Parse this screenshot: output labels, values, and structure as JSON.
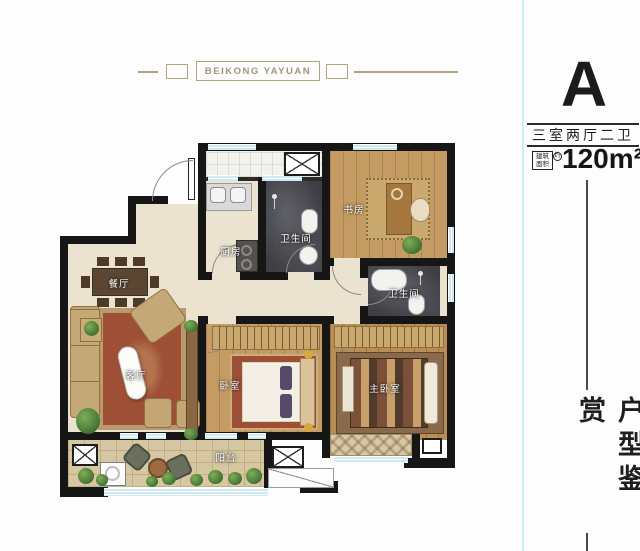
{
  "banner": {
    "title": "BEIKONG YAYUAN"
  },
  "header": {
    "unit_label": "A",
    "layout_text": "三室两厅二卫",
    "area_value": "120m²",
    "area_badge": {
      "line1": "建筑",
      "line2": "面积",
      "approx": "约"
    }
  },
  "sidebar": {
    "vertical_title": "户型鉴赏"
  },
  "floorplan": {
    "rooms": {
      "kitchen": "厨房",
      "bathroom1": "卫生间",
      "study": "书房",
      "bathroom2": "卫生间",
      "dining": "餐厅",
      "living": "客厅",
      "bedroom": "卧室",
      "master_bedroom": "主卧室",
      "balcony": "阳台"
    },
    "colors": {
      "wall": "#161616",
      "floor_cream": "#ebe3cf",
      "floor_wood": "#c49c63",
      "floor_marble": "#3e3e44",
      "floor_tile": "#d6c6a2",
      "window_blue": "#cfe9f2",
      "banner_tan": "#b0a27c"
    }
  }
}
